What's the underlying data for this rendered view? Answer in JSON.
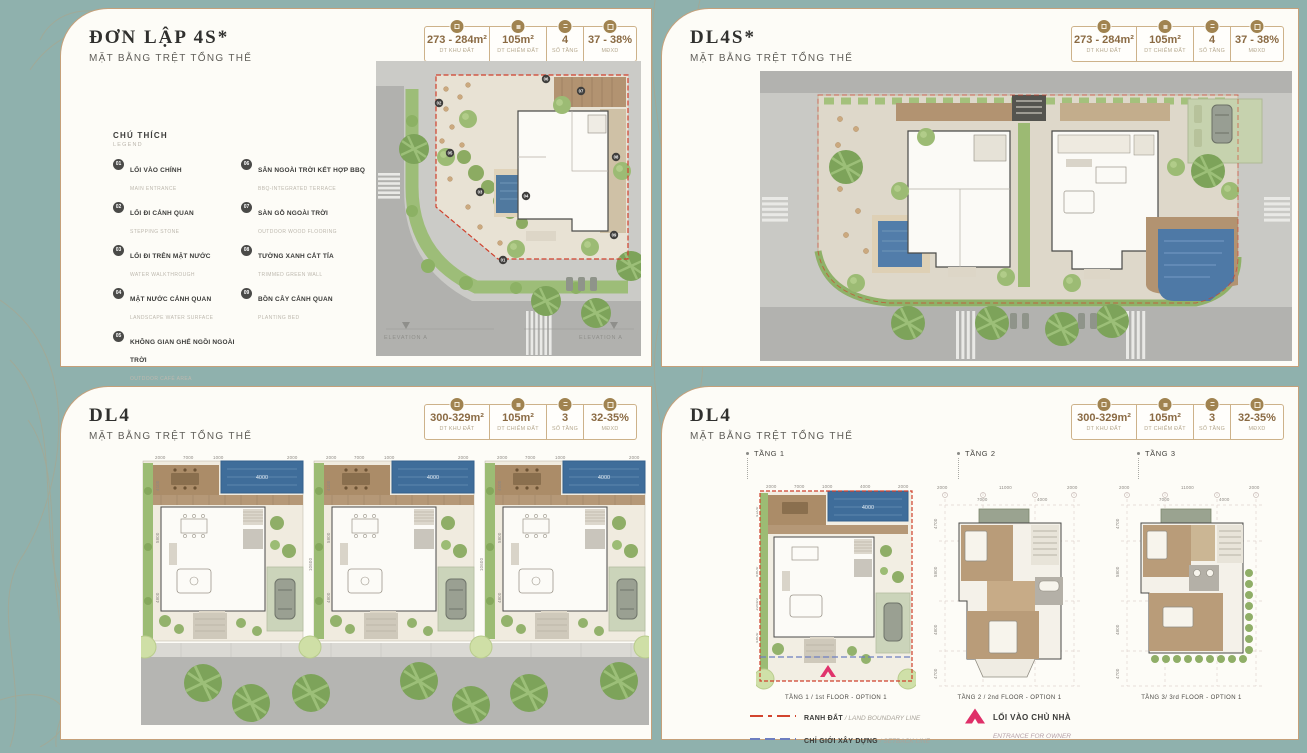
{
  "page": {
    "background_color": "#8fb1ad",
    "accent_gold": "#c5a07a",
    "boundary_red": "#d2442e",
    "setback_blue": "#6d7ec0",
    "entrance_pink": "#df2f68",
    "pool_blue": "#4e79a6",
    "separator": " / "
  },
  "stat_icons": [
    "land-area-icon",
    "footprint-area-icon",
    "floor-count-icon",
    "density-icon"
  ],
  "cards": [
    {
      "title": "ĐƠN LẬP 4S*",
      "subtitle": "MẶT BẰNG TRỆT TỔNG THỂ",
      "stats": [
        {
          "value": "273 - 284m²",
          "label": "DT KHU ĐẤT"
        },
        {
          "value": "105m²",
          "label": "DT CHIẾM ĐẤT"
        },
        {
          "value": "4",
          "label": "SỐ TẦNG"
        },
        {
          "value": "37 - 38%",
          "label": "MĐXD"
        }
      ],
      "legend_title": "CHÚ THÍCH",
      "legend_subtitle": "LEGEND",
      "legend_items": [
        {
          "num": "01",
          "vi": "LỐI VÀO CHÍNH",
          "en": "MAIN ENTRANCE"
        },
        {
          "num": "02",
          "vi": "LỐI ĐI CẢNH QUAN",
          "en": "STEPPING STONE"
        },
        {
          "num": "03",
          "vi": "LỐI ĐI TRÊN MẶT NƯỚC",
          "en": "WATER WALKTHROUGH"
        },
        {
          "num": "04",
          "vi": "MẶT NƯỚC CẢNH QUAN",
          "en": "LANDSCAPE WATER SURFACE"
        },
        {
          "num": "05",
          "vi": "KHÔNG GIAN GHẾ NGỒI NGOÀI TRỜI",
          "en": "OUTDOOR CAFÉ AREA"
        },
        {
          "num": "06",
          "vi": "SÂN NGOÀI TRỜI KẾT HỢP BBQ",
          "en": "BBQ-INTEGRATED TERRACE"
        },
        {
          "num": "07",
          "vi": "SÀN GỖ NGOÀI TRỜI",
          "en": "OUTDOOR WOOD FLOORING"
        },
        {
          "num": "08",
          "vi": "TƯỜNG XANH CẮT TỈA",
          "en": "TRIMMED GREEN WALL"
        },
        {
          "num": "09",
          "vi": "BỒN CÂY CẢNH QUAN",
          "en": "PLANTING BED"
        }
      ],
      "legend_boundary": {
        "vi": "RANH ĐẤT",
        "en": "LAND BOUNDARY LINE"
      },
      "plan": {
        "elevation_left": "ELEVATION A",
        "elevation_right": "ELEVATION A",
        "badges": [
          "01",
          "02",
          "03",
          "04",
          "05",
          "06",
          "07",
          "08",
          "09"
        ]
      }
    },
    {
      "title": "DL4S*",
      "subtitle": "MẶT BẰNG TRỆT TỔNG THỂ",
      "stats": [
        {
          "value": "273 - 284m²",
          "label": "DT KHU ĐẤT"
        },
        {
          "value": "105m²",
          "label": "DT CHIẾM ĐẤT"
        },
        {
          "value": "4",
          "label": "SỐ TẦNG"
        },
        {
          "value": "37 - 38%",
          "label": "MĐXD"
        }
      ]
    },
    {
      "title": "DL4",
      "subtitle": "MẶT BẰNG TRỆT TỔNG THỂ",
      "stats": [
        {
          "value": "300-329m²",
          "label": "DT KHU ĐẤT"
        },
        {
          "value": "105m²",
          "label": "DT CHIẾM ĐẤT"
        },
        {
          "value": "3",
          "label": "SỐ TẦNG"
        },
        {
          "value": "32-35%",
          "label": "MĐXD"
        }
      ],
      "plan": {
        "pool_dim": "4000",
        "top_dims": [
          "2000",
          "7000",
          "1000",
          "2000"
        ],
        "left_dims": [
          "4100",
          "5800",
          "10600",
          "4800"
        ]
      }
    },
    {
      "title": "DL4",
      "subtitle": "MẶT BẰNG TRỆT TỔNG THỂ",
      "stats": [
        {
          "value": "300-329m²",
          "label": "DT KHU ĐẤT"
        },
        {
          "value": "105m²",
          "label": "DT CHIẾM ĐẤT"
        },
        {
          "value": "3",
          "label": "SỐ TẦNG"
        },
        {
          "value": "32-35%",
          "label": "MĐXD"
        }
      ],
      "floors": [
        {
          "label": "TẦNG 1",
          "caption": "TẦNG 1 / 1st FLOOR - OPTION 1"
        },
        {
          "label": "TẦNG 2",
          "caption": "TẦNG 2 / 2nd FLOOR - OPTION 1"
        },
        {
          "label": "TẦNG 3",
          "caption": "TẦNG 3/ 3rd FLOOR - OPTION 1"
        }
      ],
      "dims": {
        "t1_pool": "4000",
        "t1_top": [
          "2000",
          "7000",
          "1000",
          "4000",
          "2000"
        ],
        "t1_left": [
          "4100",
          "5800",
          "10600",
          "4800"
        ],
        "t2_top": [
          "2000",
          "11000",
          "2000"
        ],
        "t2_top2": [
          "7000",
          "4000"
        ],
        "t2_left": [
          "4700",
          "5800",
          "10600",
          "4800",
          "4700"
        ]
      },
      "legend": [
        {
          "vi": "RANH ĐẤT",
          "en": "LAND BOUNDARY LINE"
        },
        {
          "vi": "CHỈ GIỚI XÂY DỰNG",
          "en": "SETBACK LINE"
        },
        {
          "vi": "LỐI VÀO CHỦ NHÀ",
          "en": "ENTRANCE FOR OWNER"
        }
      ]
    }
  ]
}
